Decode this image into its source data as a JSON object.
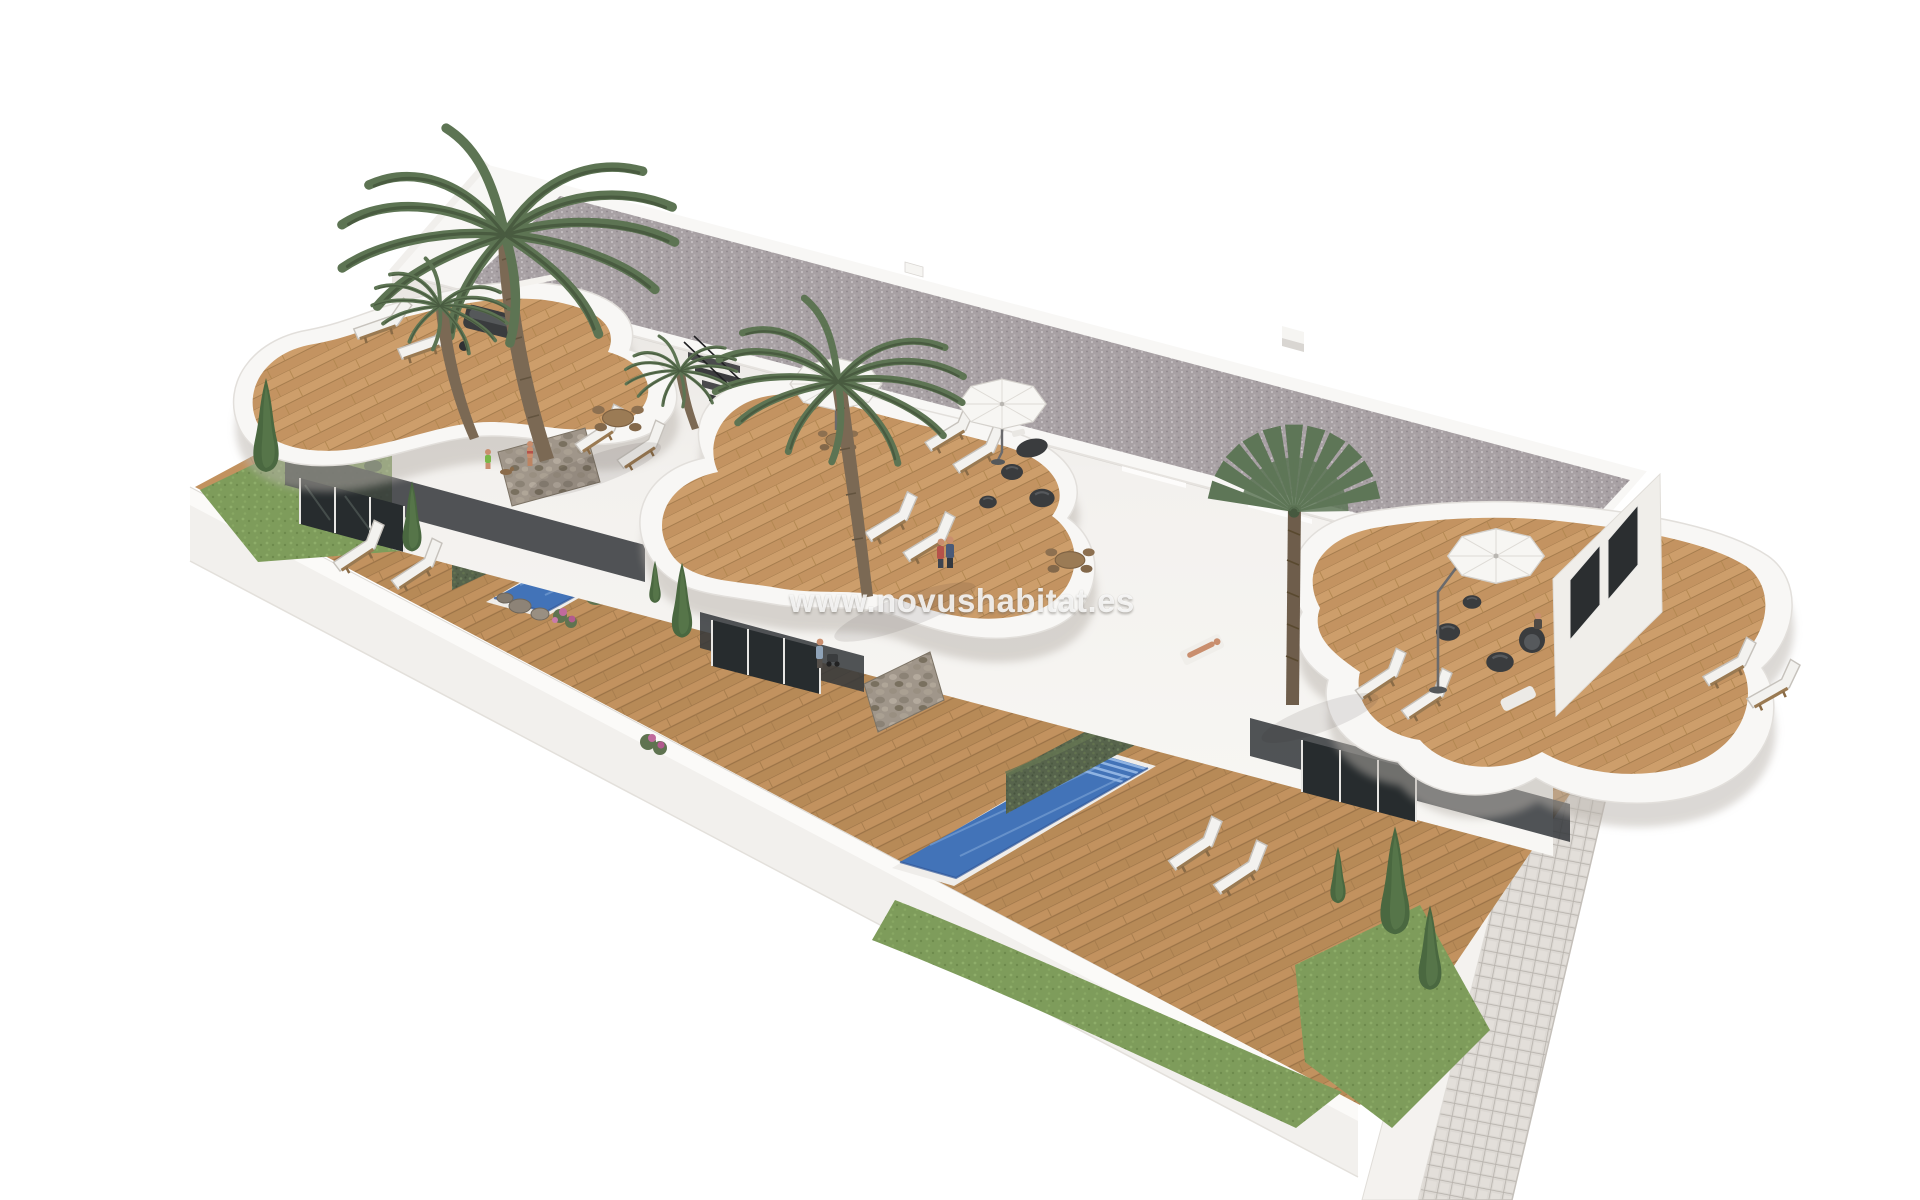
{
  "image": {
    "type": "architectural-3d-render",
    "subject": "Aerial 3D visualization of a row of three white modern townhouses, each with a private pool, wooden deck garden, curved roof terrace, palm trees, sun loungers and parasols, surrounded by a white perimeter wall with a cobbled path on the right",
    "background_color": "#ffffff"
  },
  "watermark": {
    "text": "www.novushabitat.es"
  },
  "palette": {
    "building_white": "#f5f3f0",
    "roof_gravel": "#a8a1a4",
    "deck_wood": "#c2925f",
    "terrace_wood": "#cd9e6b",
    "pool_water": "#4273b8",
    "pool_steps": "#8fb3e2",
    "hedge_green": "#57644c",
    "lawn_green": "#7e9c5b",
    "conifer_green": "#4a6840",
    "palm_green": "#5d7453",
    "stone_wall": "#a0968a",
    "tile_path": "#dcd8d3",
    "window_glass": "#2b2e30",
    "furniture_dark": "#3a3c3e",
    "lounger_white": "#f3f2ef"
  },
  "scene": {
    "townhouse_units": 3,
    "pools": 3,
    "roof_terraces": 3,
    "palm_trees": 4,
    "parasols": 3,
    "sun_loungers": 16,
    "dining_tables": 2,
    "people": 7
  }
}
